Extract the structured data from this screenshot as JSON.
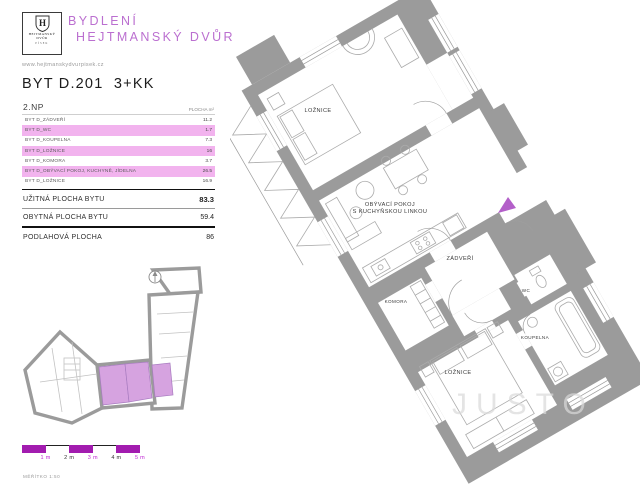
{
  "header": {
    "logo": {
      "monogram": "H",
      "name_line1": "HEJTMANSKÝ",
      "name_line2": "DVŮR",
      "city": "PÍSEK"
    },
    "brand_line1": "BYDLENÍ",
    "brand_line2": "HEJTMANSKÝ DVŮR",
    "website": "www.hejtmanskydvurpisek.cz",
    "unit_title": "BYT D.201  3+KK"
  },
  "area_table": {
    "floor": "2.NP",
    "area_unit_header": "PLOCHA m²",
    "rooms": [
      {
        "label": "BYT D_ZÁDVEŘÍ",
        "value": "11.2",
        "highlight": false
      },
      {
        "label": "BYT D_WC",
        "value": "1.7",
        "highlight": true
      },
      {
        "label": "BYT D_KOUPELNA",
        "value": "7.3",
        "highlight": false
      },
      {
        "label": "BYT D_LOŽNICE",
        "value": "16",
        "highlight": true
      },
      {
        "label": "BYT D_KOMORA",
        "value": "3.7",
        "highlight": false
      },
      {
        "label": "BYT D_OBÝVACÍ POKOJ, KUCHYNĚ, JÍDELNA",
        "value": "26.5",
        "highlight": true
      },
      {
        "label": "BYT D_LOŽNICE",
        "value": "16.9",
        "highlight": false
      }
    ],
    "summary": [
      {
        "label": "UŽITNÁ PLOCHA BYTU",
        "value": "83.3"
      },
      {
        "label": "OBYTNÁ PLOCHA BYTU",
        "value": "59.4"
      },
      {
        "label": "PODLAHOVÁ PLOCHA",
        "value": "86"
      }
    ]
  },
  "floor_plan": {
    "room_labels": {
      "bedroom_top": "LOŽNICE",
      "living_room_line1": "OBÝVACÍ POKOJ",
      "living_room_line2": "S KUCHYŇSKOU LINKOU",
      "hall": "ZÁDVEŘÍ",
      "closet": "KOMORA",
      "wc": "WC",
      "bathroom": "KOUPELNA",
      "bedroom_bottom": "LOŽNICE"
    }
  },
  "scale_bar": {
    "labels": [
      "1 m",
      "2 m",
      "3 m",
      "4 m",
      "5 m"
    ],
    "caption": "MĚŘÍTKO 1:50"
  },
  "watermark": "JUSTO",
  "colors": {
    "brand": "#bb6fd0",
    "row_highlight": "#f2b3ee",
    "scale_purple": "#a21caf",
    "scale_label": "#c026d3",
    "wall_gray": "#9b9b9b",
    "room_highlight": "#d6a3e0",
    "entrance_marker": "#b35fc9"
  }
}
